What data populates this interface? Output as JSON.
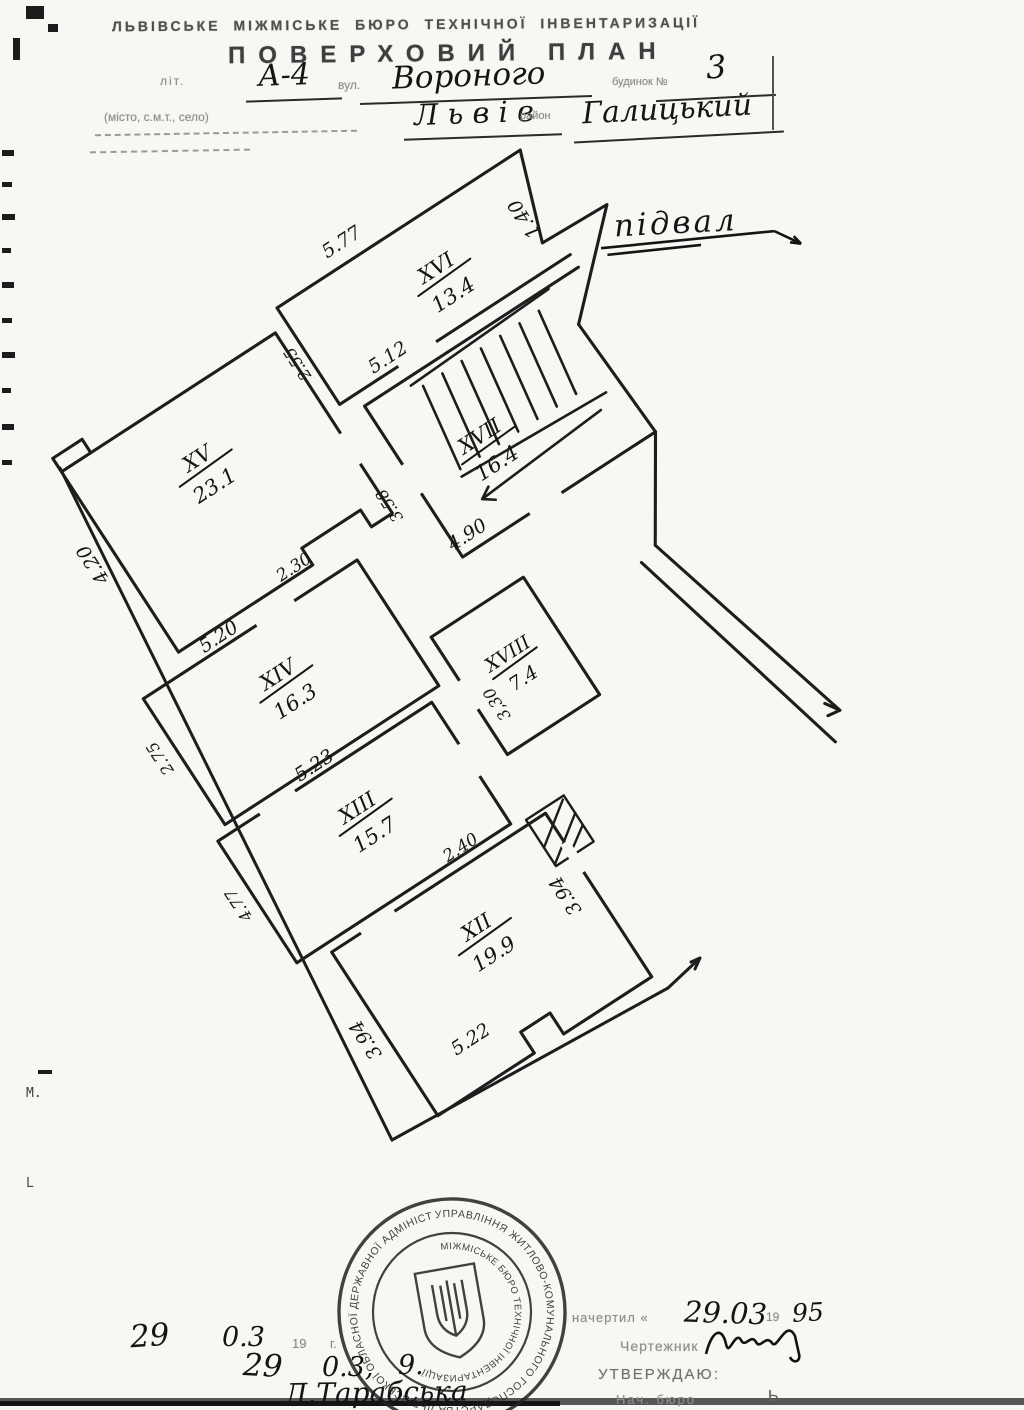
{
  "header": {
    "org": "ЛЬВІВСЬКЕ  МІЖМІСЬКЕ  БЮРО  ТЕХНІЧНОЇ  ІНВЕНТАРИЗАЦІЇ",
    "title": "ПОВЕРХОВИЙ  ПЛАН",
    "lit_label": "літ.",
    "lit_value": "А-4",
    "street_label": "вул.",
    "street_value": "Вороного",
    "house_label": "будинок №",
    "house_value": "3",
    "settlement_label": "(місто, с.м.т., село)",
    "city_value": "Л ь в і в",
    "district_label": "район",
    "district_value": "Галицький"
  },
  "plan": {
    "caption": "підвал",
    "rooms": [
      {
        "number": "XVI",
        "area": "13.4"
      },
      {
        "number": "XV",
        "area": "23.1"
      },
      {
        "number": "XVII",
        "area": "16.4"
      },
      {
        "number": "XIV",
        "area": "16.3"
      },
      {
        "number": "XVIII",
        "area": "7.4"
      },
      {
        "number": "XIII",
        "area": "15.7"
      },
      {
        "number": "XII",
        "area": "19.9"
      }
    ],
    "dims": {
      "d577": "5.77",
      "d140": "1.40",
      "d512": "5.12",
      "d255": "2.55",
      "d358": "3.58",
      "d490": "4.90",
      "d230": "2.30",
      "d420": "4.20",
      "d520": "5.20",
      "d275": "2.75",
      "d523": "5.23",
      "d330": "3,30",
      "d240": "2.40",
      "d477": "4.77",
      "d394a": "3.94",
      "d522": "5.22",
      "d394b": "3.94"
    }
  },
  "stamp": {
    "outer": "УПРАВЛІННЯ ЖИТЛОВО-КОМУНАЛЬНОГО ГОСПОДАРСТВА ЛЬВІВСЬКОЇ ОБЛАСНОЇ ДЕРЖАВНОЇ АДМІНІСТРАЦІЇ",
    "inner": "МІЖМІСЬКЕ БЮРО ТЕХНІЧНОЇ ІНВЕНТАРИЗАЦІЇ"
  },
  "footer": {
    "date1_day": "29",
    "date1_month": "0.3",
    "date1_year_label": "19",
    "date1_g": "г.",
    "date2_day": "29",
    "date2_month": "0.3,",
    "date2_year": "9.",
    "drafter_name": "Л.Тарабська",
    "drawn_label": "начертил «",
    "drawn_date": "29.03",
    "drawn_year_prefix": "19",
    "drawn_year": "95",
    "draftsman_label": "Чертежник",
    "approve_label": "УТВЕРЖДАЮ:",
    "chief_label": "Нач. бюро",
    "chief_initial": "Ь"
  },
  "margin": {
    "m_mark": "М.",
    "l_mark": "L"
  }
}
